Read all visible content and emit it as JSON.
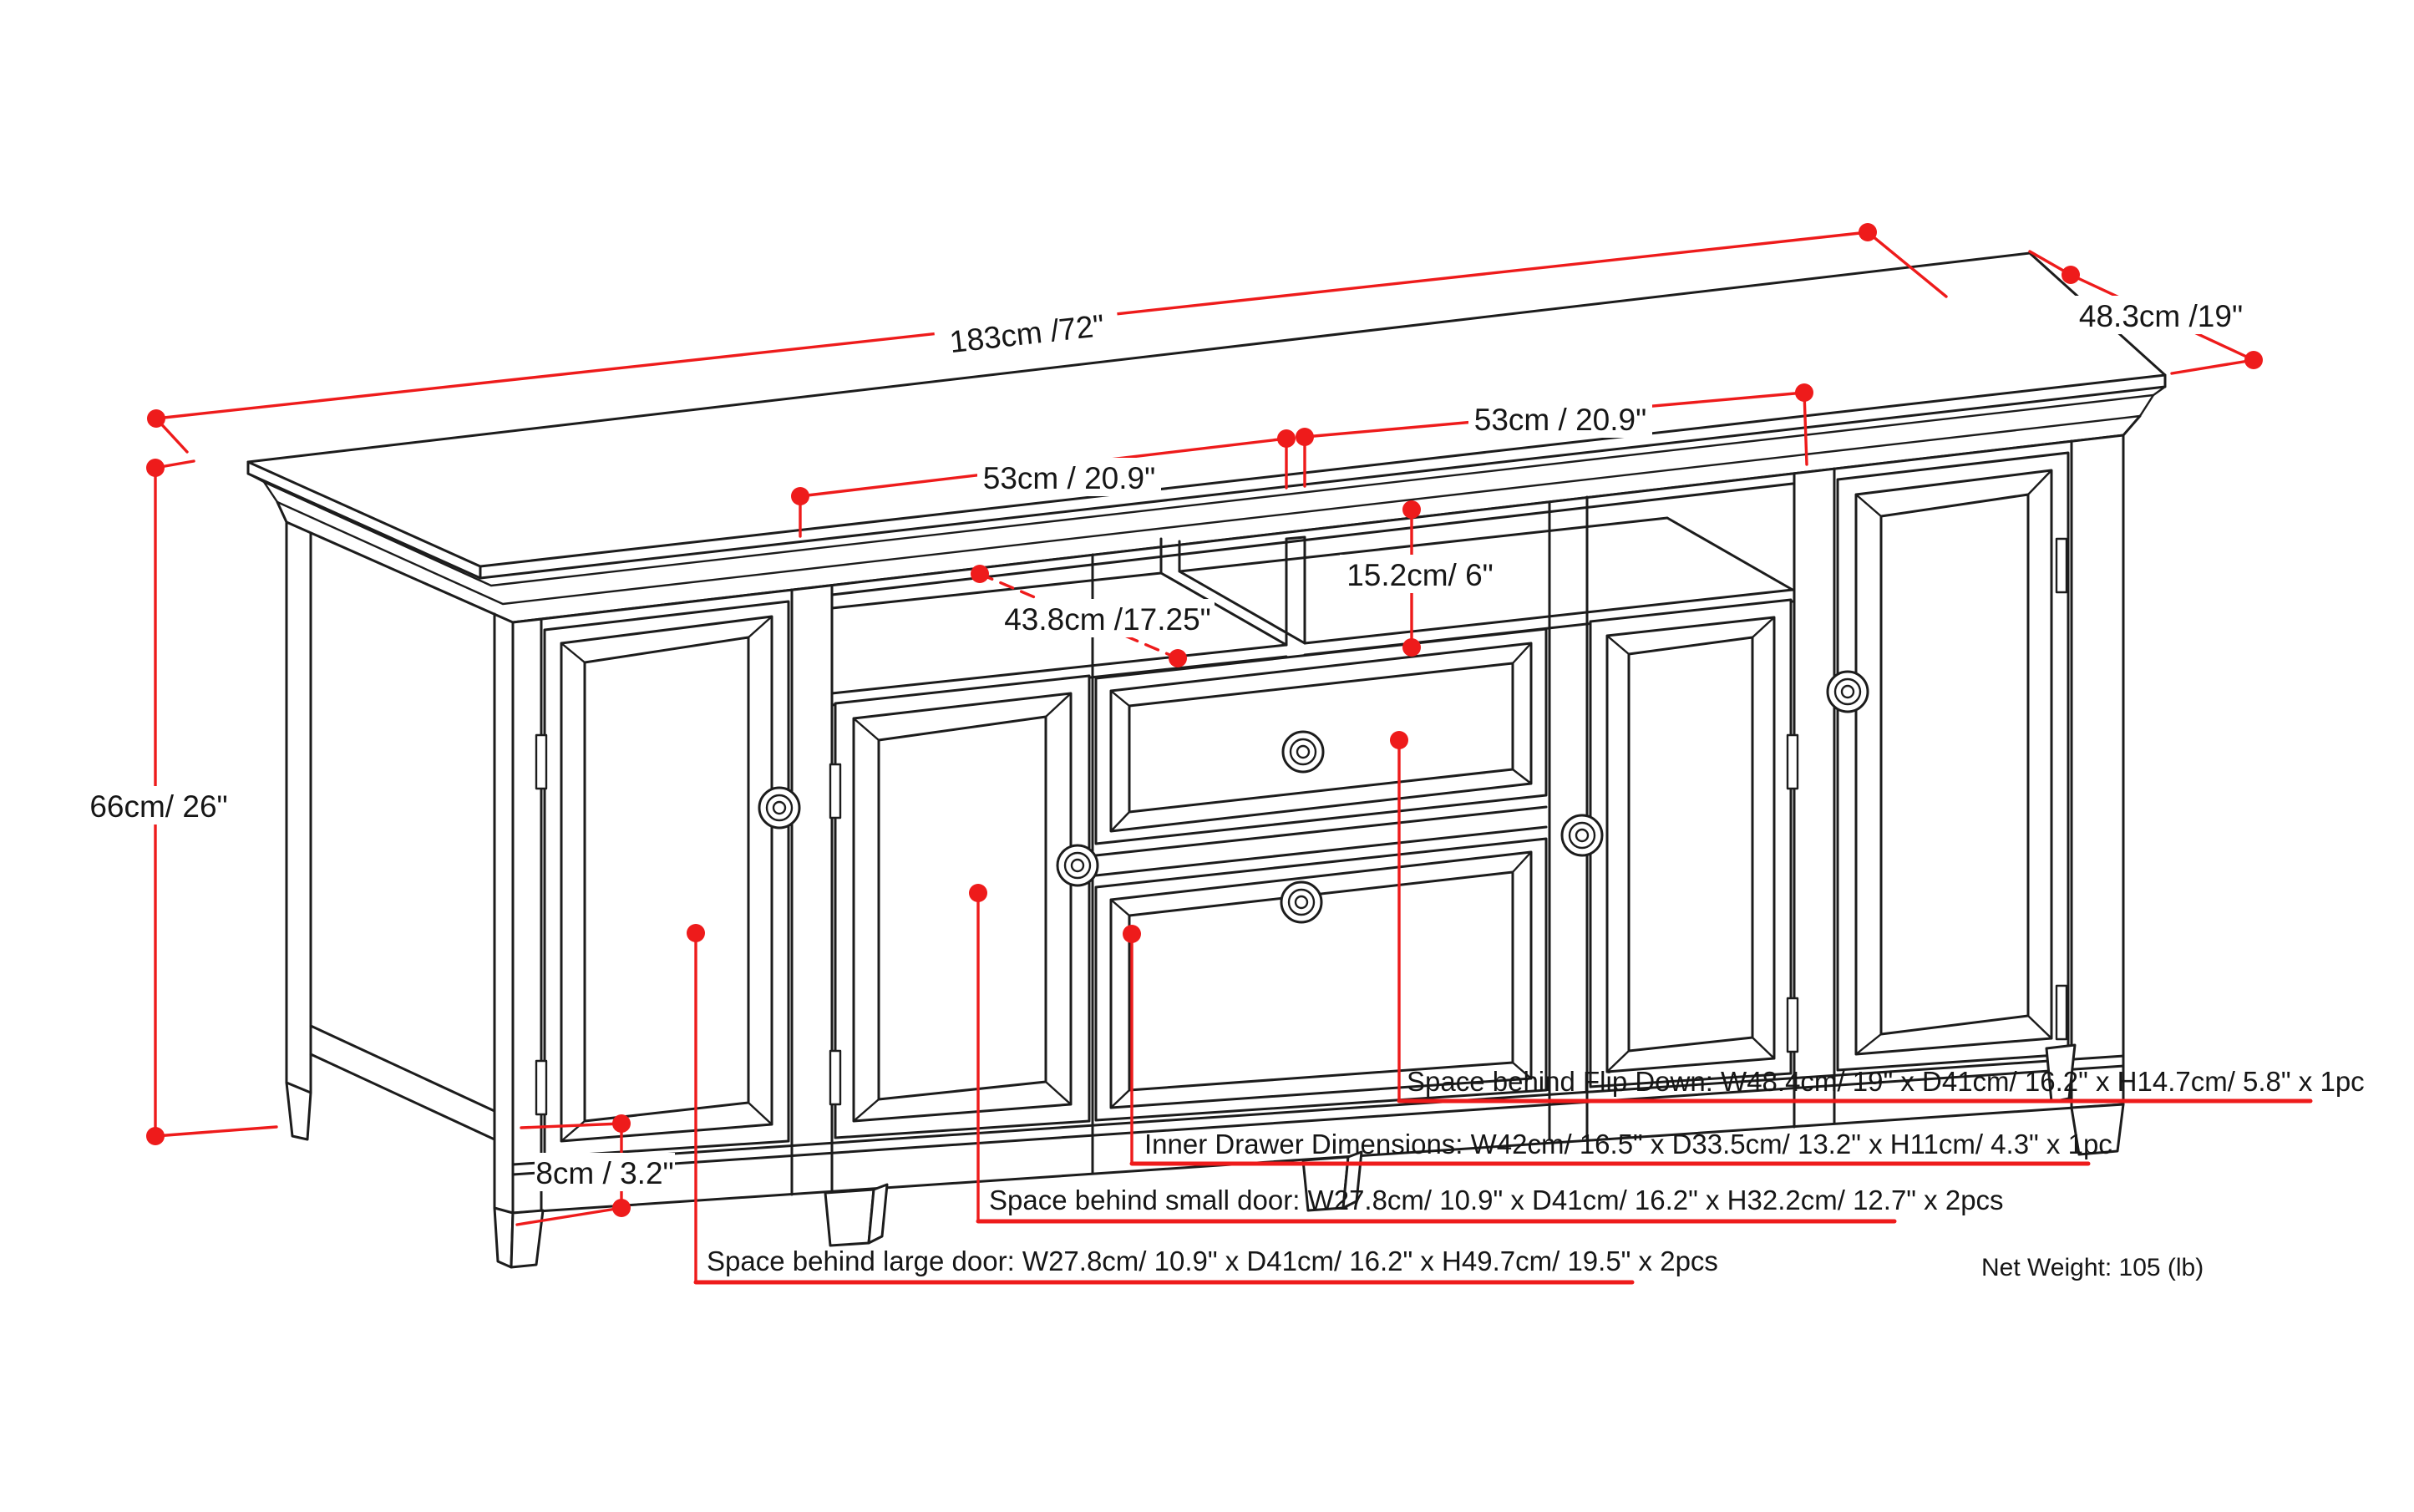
{
  "colors": {
    "red": "#ee1b1b",
    "ink": "#1c1c1c",
    "paper": "#ffffff"
  },
  "labels": {
    "top_length": "183cm /72\"",
    "top_depth": "48.3cm /19\"",
    "overall_height": "66cm/ 26\"",
    "left_shelf_width": "53cm / 20.9\"",
    "right_shelf_width": "53cm / 20.9\"",
    "shelf_opening_height": "15.2cm/ 6\"",
    "shelf_depth": "43.8cm /17.25\"",
    "leg_height": "8cm / 3.2\""
  },
  "notes": {
    "flip_down": "Space behind Flip Down: W48.4cm/ 19\" x D41cm/ 16.2\" x H14.7cm/ 5.8\" x 1pc",
    "inner_drawer": "Inner Drawer Dimensions: W42cm/ 16.5\" x D33.5cm/ 13.2\" x H11cm/ 4.3\" x 1pc",
    "small_door": "Space behind small door: W27.8cm/ 10.9\" x D41cm/ 16.2\" x H32.2cm/ 12.7\" x 2pcs",
    "large_door": "Space behind large door: W27.8cm/ 10.9\" x D41cm/ 16.2\" x H49.7cm/ 19.5\" x 2pcs"
  },
  "footer": {
    "net_weight": "Net Weight: 105 (lb)"
  }
}
